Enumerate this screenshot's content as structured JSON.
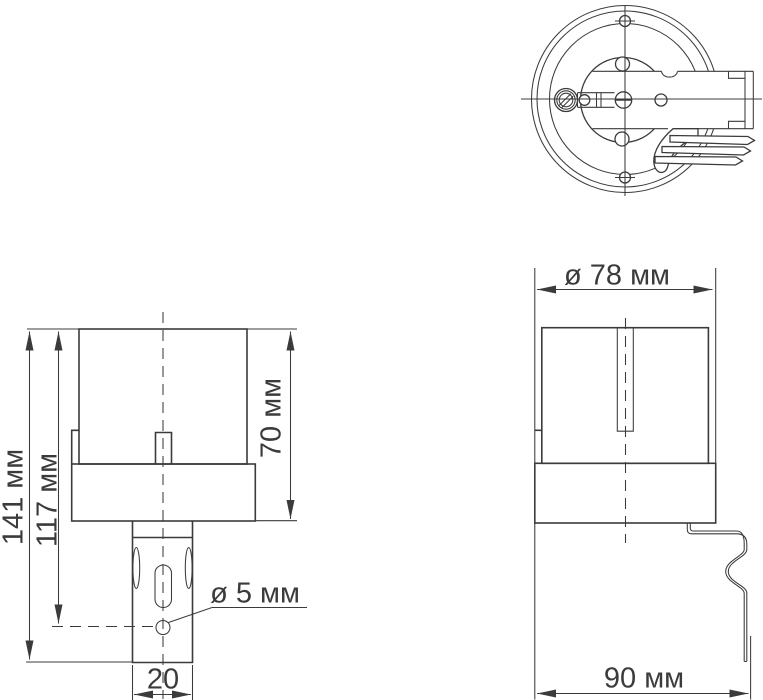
{
  "diagram": {
    "background_color": "#ffffff",
    "line_color": "#3b3b3b",
    "front_view": {
      "total_height_label": "141 мм",
      "mount_hole_height_label": "117 мм",
      "body_height_label": "70 мм",
      "hole_diameter_label": "ø 5 мм",
      "stem_width_label": "20"
    },
    "side_view": {
      "diameter_label": "ø 78 мм",
      "depth_label": "90 мм"
    }
  }
}
